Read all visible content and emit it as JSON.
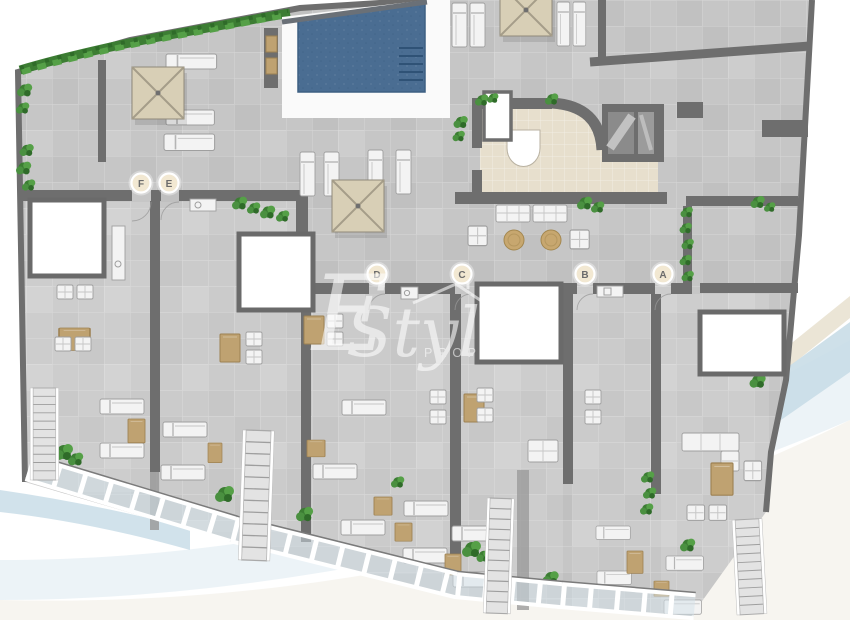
{
  "plan": {
    "kind": "residential-floor-plan",
    "units": [
      {
        "label": "F"
      },
      {
        "label": "E"
      },
      {
        "label": "D"
      },
      {
        "label": "C"
      },
      {
        "label": "B"
      },
      {
        "label": "A"
      }
    ]
  },
  "watermark": {
    "initial": "E",
    "name": "Style",
    "subtitle": "PROPER"
  },
  "icons": {
    "pool": "swimming-pool",
    "parasol": "parasol",
    "lounger": "sun-lounger",
    "chair": "chair",
    "sofa": "sofa",
    "table": "table",
    "plant": "bush",
    "stairs": "stairs",
    "elevator": "elevator"
  },
  "colors": {
    "paving": "#c6c6c6",
    "wall": "#6e6e6e",
    "pool_water": "#4a6d92",
    "pool_deck": "#fafafa",
    "lobby_floor": "#e7dfcd",
    "furniture_tan": "#bfa271",
    "furniture_white": "#f3f3f3",
    "plant_green": "#4a9040",
    "hedge_green": "#3c7d33",
    "label_bg": "#f2e8d2",
    "label_text": "#6b6b6b",
    "swoosh_blue": "#c9dde7",
    "swoosh_sand": "#e6dfcc",
    "watermark_white": "#ffffff"
  }
}
